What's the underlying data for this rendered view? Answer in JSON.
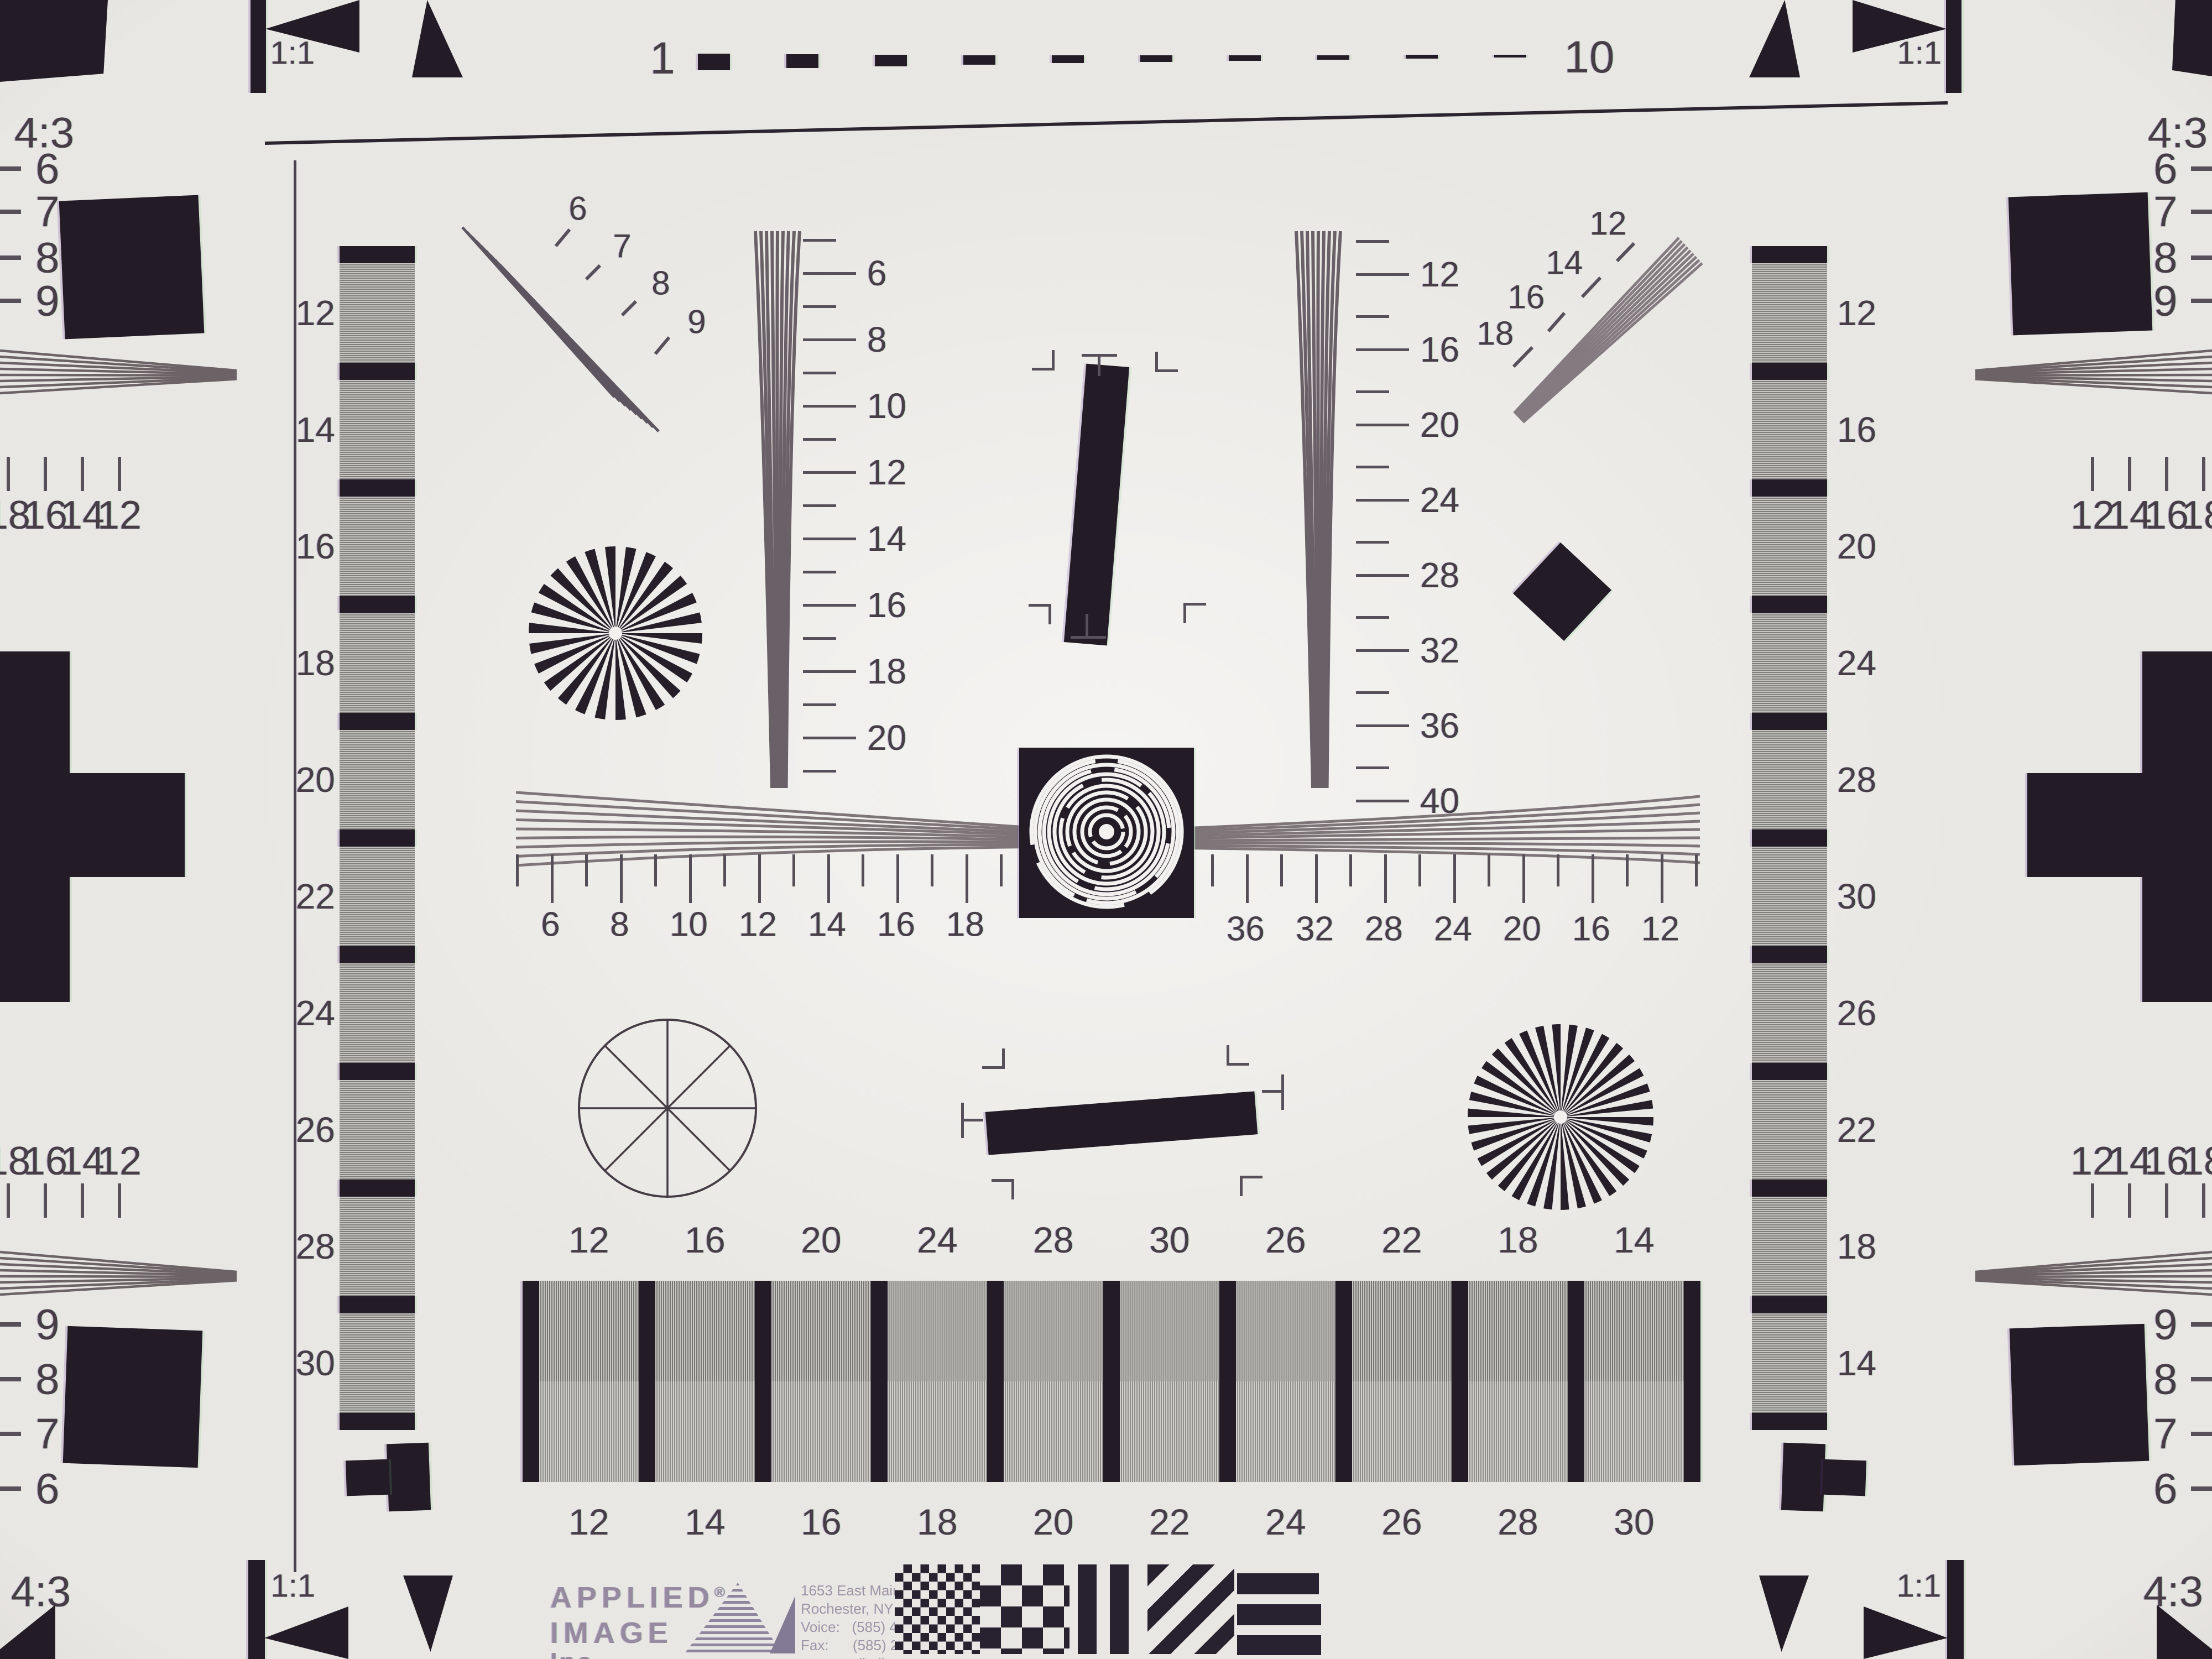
{
  "colors": {
    "background": "#e9e7e3",
    "ink_black": "#231c27",
    "label_ink": "#463d47",
    "grating_gray": "#a4a29f",
    "logo_lavender": "#968aa0",
    "fringe_purple": "#6937a0",
    "fringe_green": "#6ec87d"
  },
  "top_strip": {
    "left_ratio": "1:1",
    "right_ratio": "1:1",
    "tl_corner": "4:3",
    "tr_corner": "4:3",
    "scale_start": "1",
    "scale_end": "10",
    "dash_count": 10
  },
  "bottom_strip": {
    "left_ratio": "1:1",
    "right_ratio": "1:1",
    "bl_corner": "4:3",
    "br_corner": "4:3"
  },
  "left_column_labels": [
    "12",
    "14",
    "16",
    "18",
    "20",
    "22",
    "24",
    "26",
    "28",
    "30"
  ],
  "right_column_labels": [
    "12",
    "16",
    "20",
    "24",
    "28",
    "30",
    "26",
    "22",
    "18",
    "14"
  ],
  "edge_scales": {
    "left_top": [
      "6",
      "7",
      "8",
      "9"
    ],
    "left_mid_upper": [
      "18",
      "16",
      "14",
      "12"
    ],
    "left_mid_lower": [
      "18",
      "16",
      "14",
      "12"
    ],
    "left_bottom": [
      "9",
      "8",
      "7",
      "6"
    ],
    "right_top": [
      "6",
      "7",
      "8",
      "9"
    ],
    "right_mid_upper": [
      "12",
      "14",
      "16",
      "18"
    ],
    "right_mid_lower": [
      "12",
      "14",
      "16",
      "18"
    ],
    "right_bottom": [
      "9",
      "8",
      "7",
      "6"
    ]
  },
  "fan_tl_labels": [
    "6",
    "7",
    "8",
    "9"
  ],
  "fan_tr_labels": [
    "12",
    "14",
    "16",
    "18"
  ],
  "vwedge_left_labels": [
    "6",
    "8",
    "10",
    "12",
    "14",
    "16",
    "18",
    "20"
  ],
  "vwedge_right_labels": [
    "12",
    "16",
    "20",
    "24",
    "28",
    "32",
    "36",
    "40"
  ],
  "hruler_left_labels": [
    "6",
    "8",
    "10",
    "12",
    "14",
    "16",
    "18"
  ],
  "hruler_right_labels": [
    "36",
    "32",
    "28",
    "24",
    "20",
    "16",
    "12"
  ],
  "grating_top_labels": [
    "12",
    "16",
    "20",
    "24",
    "28",
    "30",
    "26",
    "22",
    "18",
    "14"
  ],
  "grating_bottom_labels": [
    "12",
    "14",
    "16",
    "18",
    "20",
    "22",
    "24",
    "26",
    "28",
    "30"
  ],
  "branding": {
    "company_line1": "APPLIED",
    "registered_mark": "®",
    "company_line2": "IMAGE",
    "company_line3": "Inc",
    "address_lines": [
      "1653 East Main Street",
      "Rochester, NY  14609  USA",
      "Voice:   (585) 482-0300",
      "Fax:      (585) 288-5989",
      "www.appliedimage.com"
    ]
  }
}
